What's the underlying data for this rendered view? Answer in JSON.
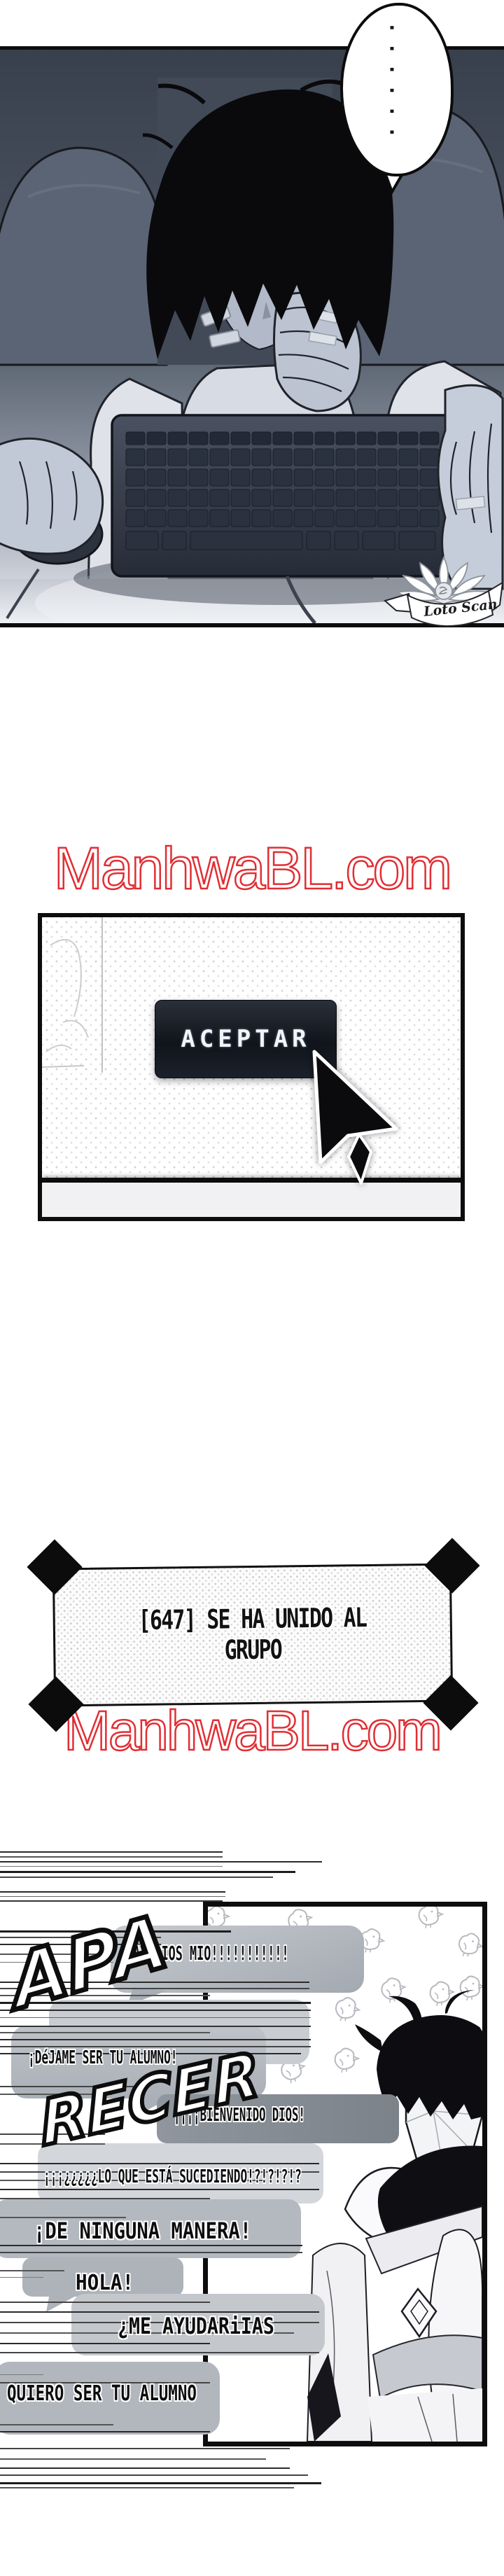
{
  "page": {
    "watermark": "ManhwaBL.com",
    "watermark2": "ManhwaBL.com",
    "watermark_color": "#e12e34"
  },
  "panel1": {
    "bubble_dots": "......",
    "logo_text": "Loto Scan"
  },
  "panel2": {
    "button_label": "ACEPTAR"
  },
  "dialog": {
    "line1": "[647] SE HA UNIDO AL",
    "line2": "GRUPO"
  },
  "panel4": {
    "sfx_top": "APA",
    "sfx_bottom": "RECER",
    "bubbles": [
      {
        "text": "¡AY DIOS MIO!!!!!!!!!!!"
      },
      {
        "text": "¡DéJAME SER TU ALUMNO!"
      },
      {
        "text": "¡¡¡¡BIENVENIDO DIOS!"
      },
      {
        "text": "¡¡¡¿¿¿¿¿LO QUE ESTÁ SUCEDIENDO!?!?!?!?"
      },
      {
        "text": "¡DE NINGUNA MANERA!"
      },
      {
        "text": "HOLA!"
      },
      {
        "text": "¿ME AYUDARiIAS"
      },
      {
        "text": "QUIERO SER TU ALUMNO"
      }
    ]
  }
}
